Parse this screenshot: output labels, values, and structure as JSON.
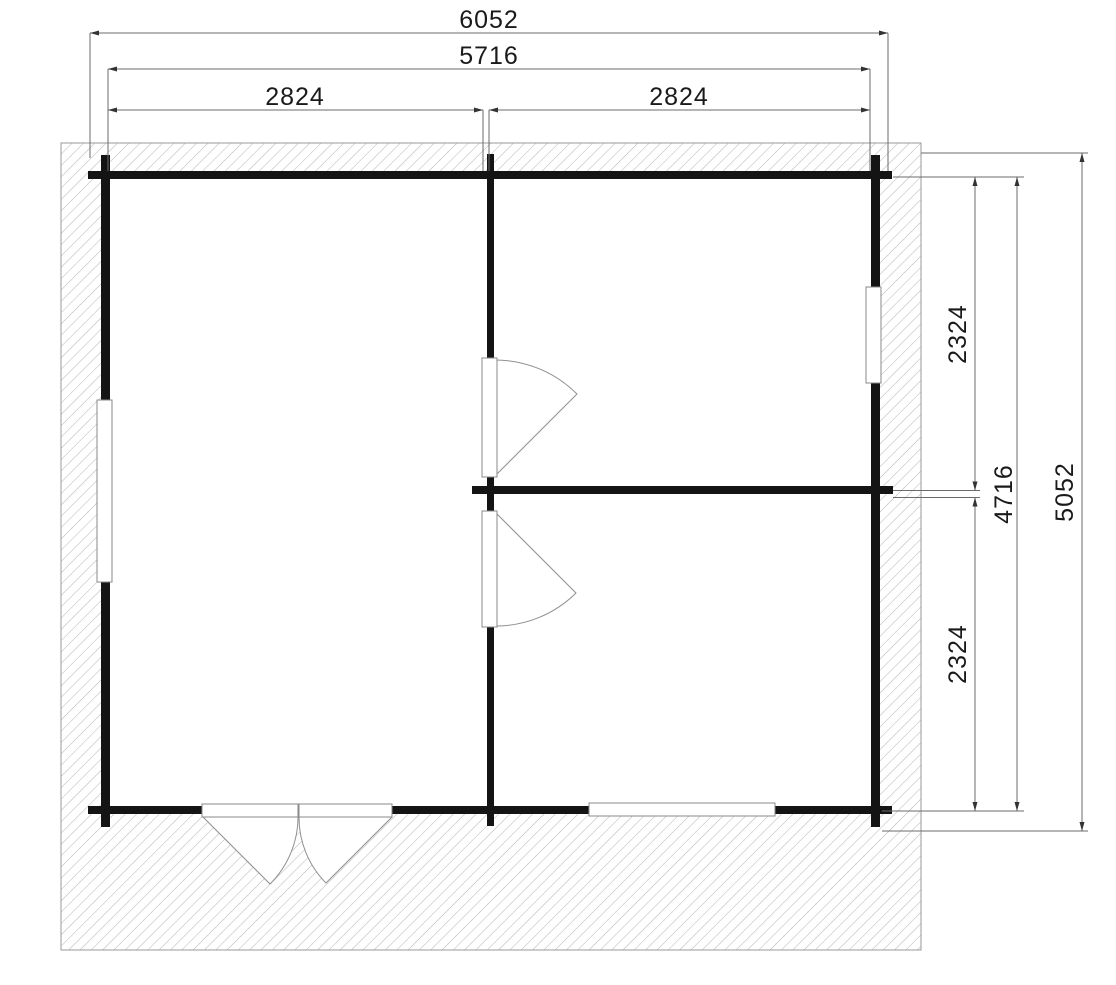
{
  "floor_plan": {
    "dims": {
      "overall_width": "6052",
      "outer_wall_width": "5716",
      "room_left_width": "2824",
      "room_right_width": "2824",
      "room_top_right_depth": "2324",
      "room_bottom_right_depth": "2324",
      "outer_wall_depth": "4716",
      "overall_depth": "5052"
    },
    "colors": {
      "wall": "#141414",
      "hatch_line": "#b4b4b4",
      "hatch_border": "#9a9a9a",
      "dimension_line": "#6b6b6b",
      "arrow": "#333333",
      "door_swing": "#8f8f8f",
      "frame_border": "#8a8a8a",
      "background": "#ffffff",
      "text": "#1a1a1a"
    }
  }
}
